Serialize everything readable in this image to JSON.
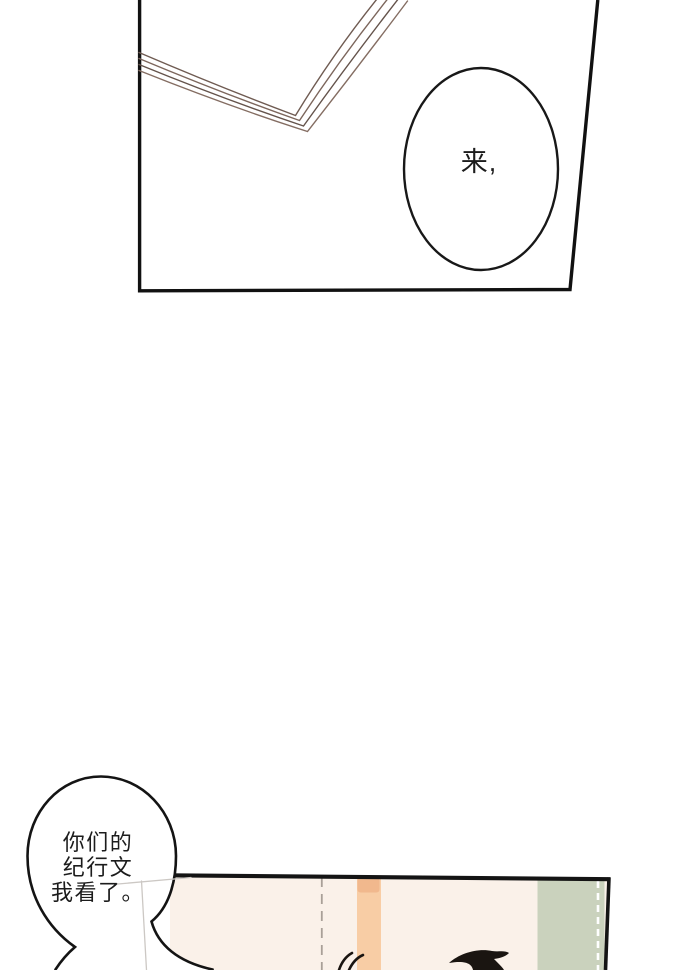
{
  "top_panel": {
    "bubble_text": "来,"
  },
  "bottom_bubble": {
    "lines": [
      "你们的",
      "纪行文",
      "我看了。"
    ]
  },
  "colors": {
    "panel_bg": "#faf1e9",
    "peach_strip": "#f8cda5",
    "peach_strip_top": "#f1b88d",
    "green_strip": "#cad2bd",
    "ink": "#141414",
    "page_line_1": "#6f5b52",
    "page_line_2": "#7c665c",
    "page_line_3": "#64534b",
    "page_line_4": "#846d62",
    "paper_edge": "#ccc8c4",
    "seam_dash": "#a9a098",
    "stitch_white": "#ffffff"
  }
}
